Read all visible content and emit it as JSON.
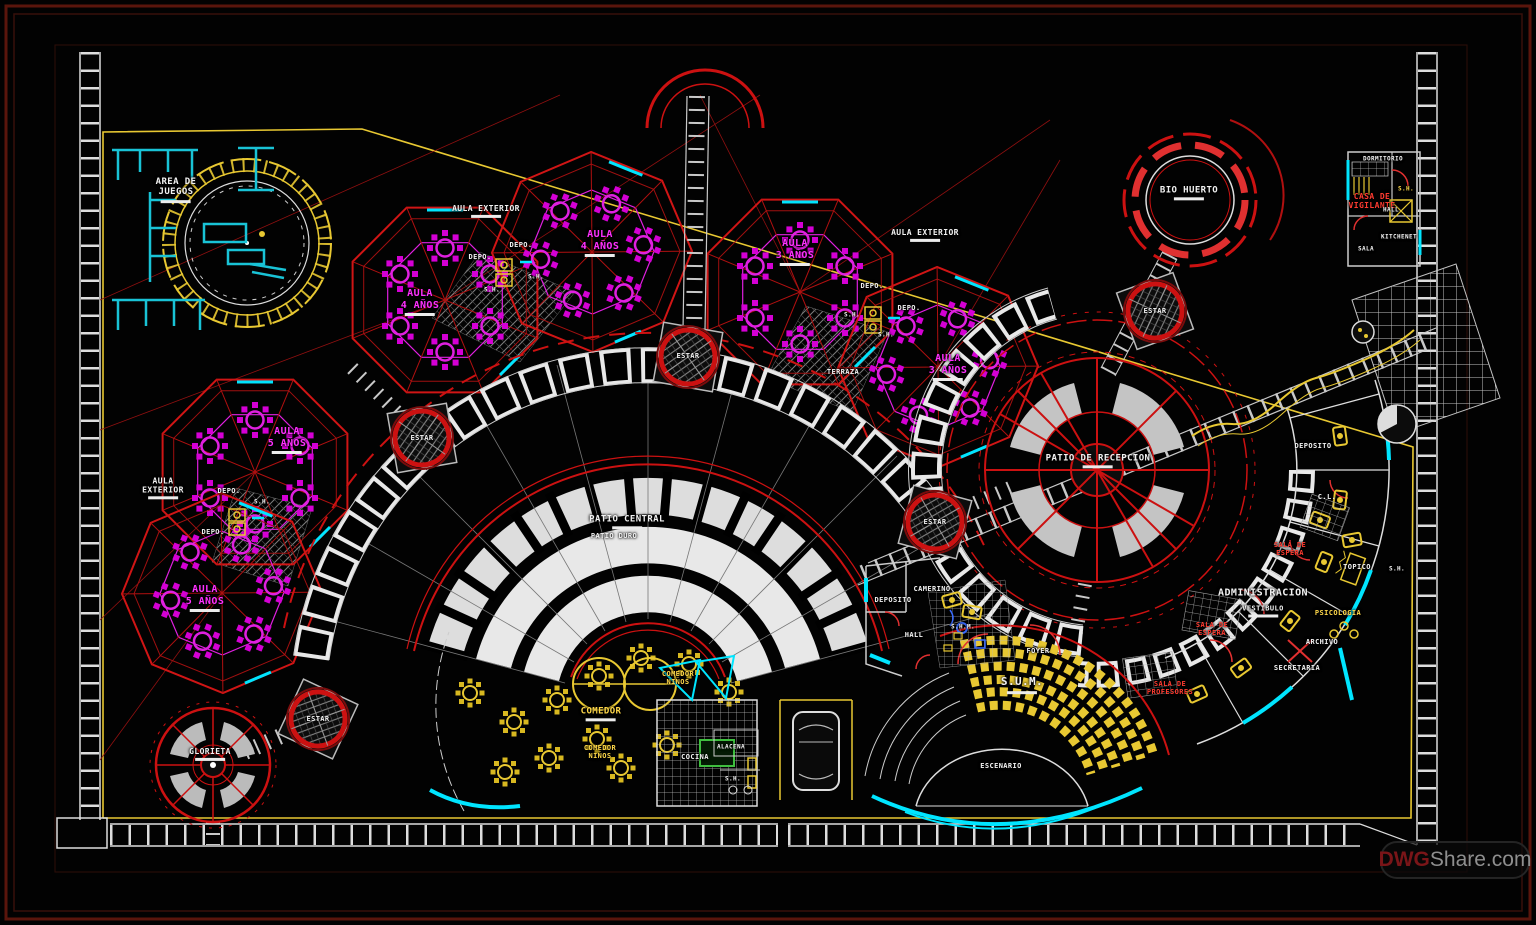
{
  "watermark": {
    "dwg": "DWG",
    "share": "Share.com"
  },
  "colors": {
    "background": "#020202",
    "line_red": "#cc1111",
    "line_yellow": "#e8c832",
    "line_cyan": "#00e5ff",
    "line_magenta": "#e020e0",
    "line_white": "#e8e8e8",
    "label_white": "#f2f2f2",
    "label_magenta": "#ff30ff",
    "label_yellow": "#ffd84a",
    "label_red": "#ff3b30",
    "frame_maroon": "#5a150c"
  },
  "labels": [
    {
      "text": "AREA DE\nJUEGOS",
      "x": 176,
      "y": 190,
      "size": 9,
      "bar": true
    },
    {
      "text": "AULA EXTERIOR",
      "x": 486,
      "y": 211,
      "size": 8,
      "bar": true
    },
    {
      "text": "DEPO.",
      "x": 521,
      "y": 245,
      "size": 7
    },
    {
      "text": "DEPO.",
      "x": 480,
      "y": 257,
      "size": 7
    },
    {
      "text": "S.H.",
      "x": 536,
      "y": 278,
      "size": 6
    },
    {
      "text": "AULA\n4 AÑOS",
      "x": 600,
      "y": 243,
      "size": 10,
      "color": "#ff30ff",
      "bar": true
    },
    {
      "text": "AULA\n4 AÑOS",
      "x": 420,
      "y": 302,
      "size": 10,
      "color": "#ff30ff",
      "bar": true
    },
    {
      "text": "S.H.",
      "x": 492,
      "y": 291,
      "size": 6
    },
    {
      "text": "AULA EXTERIOR",
      "x": 925,
      "y": 235,
      "size": 8,
      "bar": true
    },
    {
      "text": "AULA\n3 AÑOS",
      "x": 795,
      "y": 252,
      "size": 10,
      "color": "#ff30ff",
      "bar": true
    },
    {
      "text": "DEPO.",
      "x": 872,
      "y": 286,
      "size": 7
    },
    {
      "text": "DEPO.",
      "x": 909,
      "y": 308,
      "size": 7
    },
    {
      "text": "S.H.",
      "x": 852,
      "y": 316,
      "size": 6
    },
    {
      "text": "S.H.",
      "x": 886,
      "y": 336,
      "size": 6
    },
    {
      "text": "TERRAZA",
      "x": 843,
      "y": 372,
      "size": 7
    },
    {
      "text": "AULA\n3 AÑOS",
      "x": 948,
      "y": 367,
      "size": 10,
      "color": "#ff30ff",
      "bar": true
    },
    {
      "text": "AULA\nEXTERIOR",
      "x": 163,
      "y": 488,
      "size": 8,
      "bar": true
    },
    {
      "text": "AULA\n5 AÑOS",
      "x": 287,
      "y": 440,
      "size": 10,
      "color": "#ff30ff",
      "bar": true
    },
    {
      "text": "DEPO.",
      "x": 229,
      "y": 491,
      "size": 7
    },
    {
      "text": "S.H.",
      "x": 262,
      "y": 503,
      "size": 6
    },
    {
      "text": "DEPO.",
      "x": 213,
      "y": 532,
      "size": 7
    },
    {
      "text": "AULA\n5 AÑOS",
      "x": 205,
      "y": 598,
      "size": 10,
      "color": "#ff30ff",
      "bar": true
    },
    {
      "text": "ESTAR",
      "x": 688,
      "y": 356,
      "size": 7
    },
    {
      "text": "ESTAR",
      "x": 422,
      "y": 438,
      "size": 7
    },
    {
      "text": "ESTAR",
      "x": 935,
      "y": 522,
      "size": 7
    },
    {
      "text": "ESTAR",
      "x": 1155,
      "y": 311,
      "size": 7
    },
    {
      "text": "ESTAR",
      "x": 318,
      "y": 719,
      "size": 7
    },
    {
      "text": "PATIO CENTRAL",
      "x": 627,
      "y": 522,
      "size": 9,
      "bar": true
    },
    {
      "text": "PATIO DURO",
      "x": 614,
      "y": 536,
      "size": 7
    },
    {
      "text": "PATIO DE RECEPCION",
      "x": 1098,
      "y": 461,
      "size": 9,
      "bar": true
    },
    {
      "text": "BIO HUERTO",
      "x": 1189,
      "y": 193,
      "size": 9,
      "bar": true
    },
    {
      "text": "GLORIETA",
      "x": 210,
      "y": 754,
      "size": 8,
      "bar": true
    },
    {
      "text": "COMEDOR",
      "x": 601,
      "y": 714,
      "size": 9,
      "color": "#ffd84a",
      "bar": true
    },
    {
      "text": "COMEDOR\nNIÑOS",
      "x": 678,
      "y": 678,
      "size": 7,
      "color": "#ffd84a"
    },
    {
      "text": "COMEDOR\nNIÑOS",
      "x": 600,
      "y": 752,
      "size": 7,
      "color": "#ffd84a"
    },
    {
      "text": "COCINA",
      "x": 695,
      "y": 757,
      "size": 7
    },
    {
      "text": "ALACENA",
      "x": 731,
      "y": 748,
      "size": 6
    },
    {
      "text": "S.H.",
      "x": 733,
      "y": 780,
      "size": 6
    },
    {
      "text": "S.U.M.",
      "x": 1022,
      "y": 685,
      "size": 11,
      "bar": true
    },
    {
      "text": "FOYER",
      "x": 1038,
      "y": 651,
      "size": 7
    },
    {
      "text": "ESCENARIO",
      "x": 1001,
      "y": 766,
      "size": 7
    },
    {
      "text": "HALL",
      "x": 914,
      "y": 635,
      "size": 7
    },
    {
      "text": "CAMERINO",
      "x": 932,
      "y": 589,
      "size": 7
    },
    {
      "text": "DEPOSITO",
      "x": 893,
      "y": 600,
      "size": 7
    },
    {
      "text": "S.H.M.",
      "x": 963,
      "y": 628,
      "size": 6
    },
    {
      "text": "ADMINISTRACION",
      "x": 1263,
      "y": 593,
      "size": 10
    },
    {
      "text": "VESTIBULO",
      "x": 1263,
      "y": 611,
      "size": 7,
      "bar": true
    },
    {
      "text": "PSICOLOGIA",
      "x": 1338,
      "y": 613,
      "size": 7,
      "color": "#ffd84a"
    },
    {
      "text": "ARCHIVO",
      "x": 1322,
      "y": 642,
      "size": 7
    },
    {
      "text": "SECRETARIA",
      "x": 1297,
      "y": 668,
      "size": 7
    },
    {
      "text": "SALA DE\nPROFESORES",
      "x": 1170,
      "y": 688,
      "size": 7,
      "color": "#ff3b30"
    },
    {
      "text": "SALA DE\nESPERA",
      "x": 1290,
      "y": 549,
      "size": 7,
      "color": "#ff3b30"
    },
    {
      "text": "SALA DE\nESPERA",
      "x": 1212,
      "y": 629,
      "size": 7,
      "color": "#ff3b30"
    },
    {
      "text": "C.L.",
      "x": 1327,
      "y": 497,
      "size": 7
    },
    {
      "text": "TOPICO",
      "x": 1357,
      "y": 567,
      "size": 7
    },
    {
      "text": "S.H.",
      "x": 1397,
      "y": 570,
      "size": 6
    },
    {
      "text": "DEPOSITO",
      "x": 1313,
      "y": 446,
      "size": 7
    },
    {
      "text": "DORMITORIO",
      "x": 1383,
      "y": 160,
      "size": 6
    },
    {
      "text": "CASA DE\nVIGILANTE",
      "x": 1372,
      "y": 201,
      "size": 8,
      "color": "#ff3b30"
    },
    {
      "text": "HALL",
      "x": 1391,
      "y": 211,
      "size": 6
    },
    {
      "text": "S.H.",
      "x": 1406,
      "y": 190,
      "size": 6,
      "color": "#ffd84a"
    },
    {
      "text": "KITCHENET",
      "x": 1399,
      "y": 238,
      "size": 6
    },
    {
      "text": "SALA",
      "x": 1366,
      "y": 250,
      "size": 6
    }
  ]
}
